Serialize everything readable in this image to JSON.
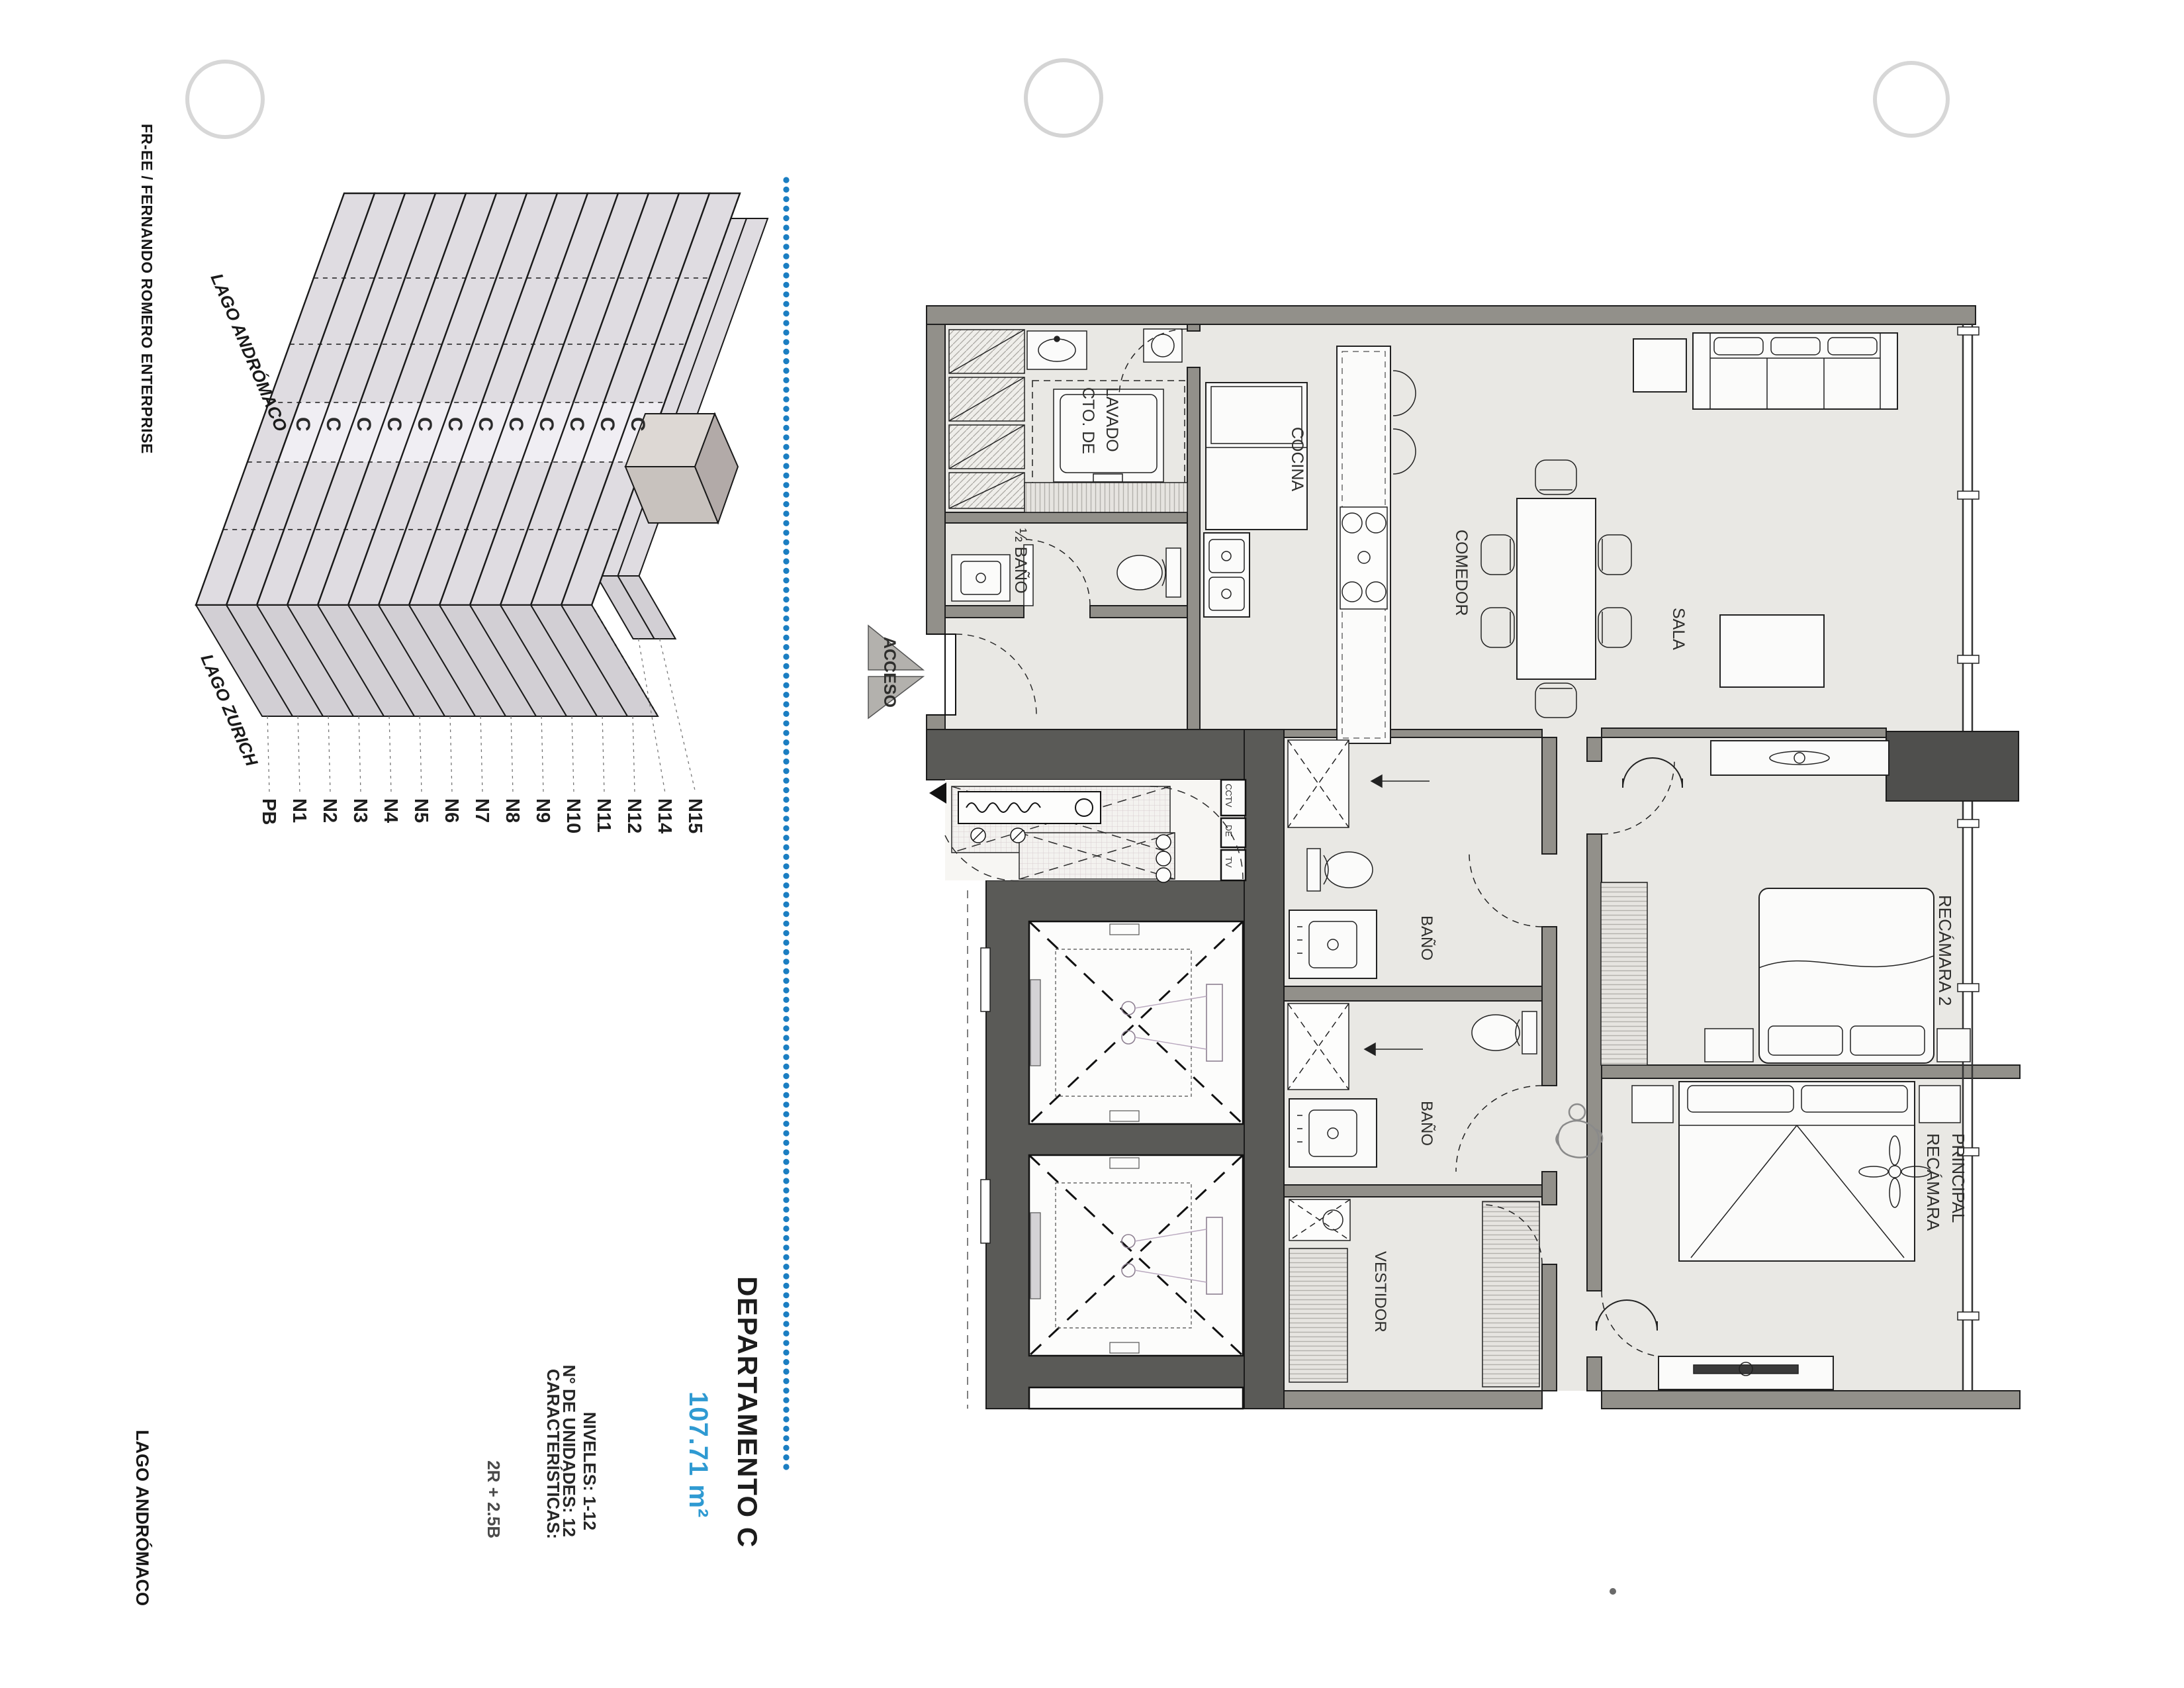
{
  "page": {
    "accent_text_blue": "#2f9ad2",
    "accent_dots_blue": "#1b7ec2",
    "paper": "#ffffff"
  },
  "side_labels": {
    "top_left": "FR-EE / FERNANDO ROMERO ENTERPRISE",
    "bottom_left": "LAGO ANDRÓMACO"
  },
  "title_block": {
    "title": "DEPARTAMENTO C",
    "area": "107.71 m²",
    "details": [
      "NIVELES: 1-12",
      "N° DE UNIDADES: 12",
      "CARACTERÍSTICAS:",
      "2R + 2.5B"
    ]
  },
  "axonometric": {
    "street_top": "LAGO ANDRÓMACO",
    "street_bottom": "LAGO ZURICH",
    "unit_marker": "C",
    "marked_floors": [
      "N1",
      "N2",
      "N3",
      "N4",
      "N5",
      "N6",
      "N7",
      "N8",
      "N9",
      "N10",
      "N11",
      "N12"
    ],
    "floor_labels": [
      "PB",
      "N1",
      "N2",
      "N3",
      "N4",
      "N5",
      "N6",
      "N7",
      "N8",
      "N9",
      "N10",
      "N11",
      "N12",
      "N14",
      "N15"
    ]
  },
  "floor_plan": {
    "access_label": "ACCESO",
    "rooms": {
      "laundry_line1": "CTO. DE",
      "laundry_line2": "LAVADO",
      "half_bath": "½ BAÑO",
      "kitchen": "COCINA",
      "dining": "COMEDOR",
      "living": "SALA",
      "bath1": "BAÑO",
      "bath2": "BAÑO",
      "walkin_closet": "VESTIDOR",
      "bedroom2": "RECÁMARA 2",
      "master_line1": "RECÁMARA",
      "master_line2": "PRINCIPAL"
    },
    "utility_cells": [
      "CCTV",
      "DE",
      "TV"
    ]
  }
}
